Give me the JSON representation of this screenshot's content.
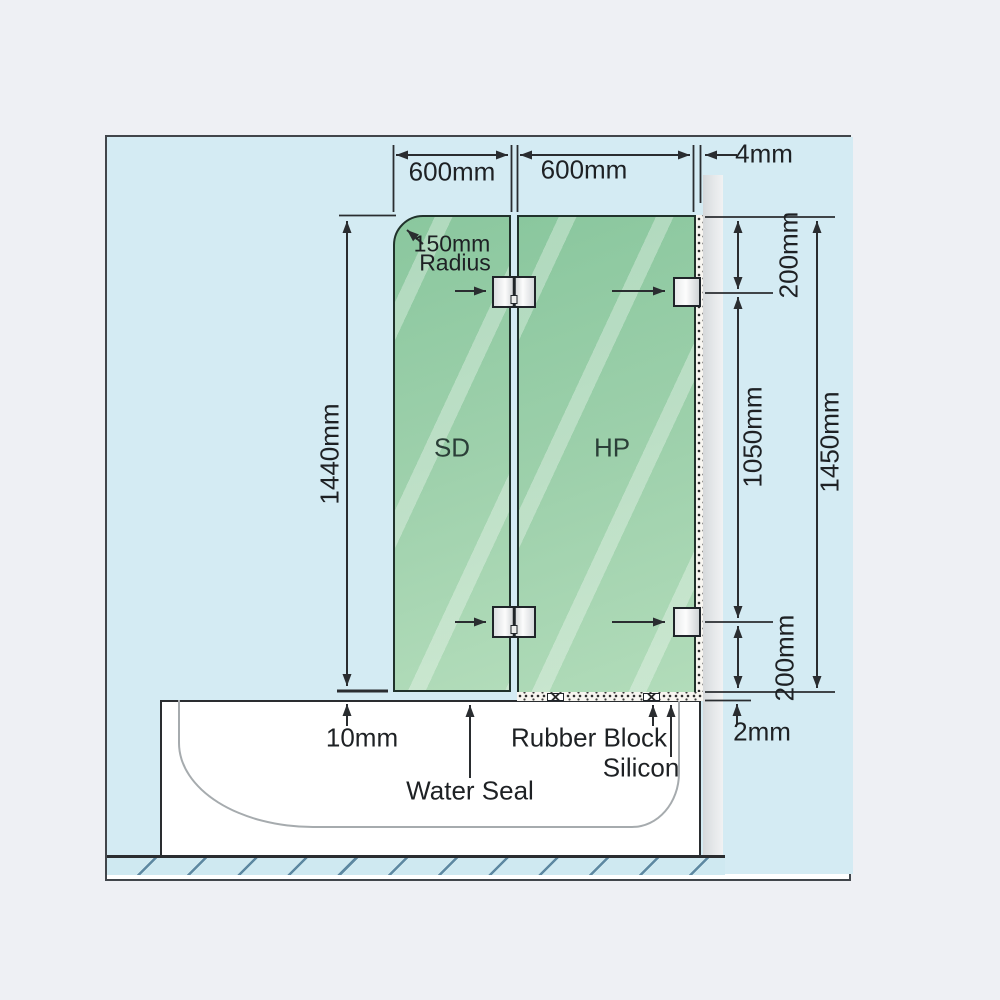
{
  "dimensions": {
    "panel_width_left": "600mm",
    "panel_width_right": "600mm",
    "wall_gap": "4mm",
    "door_height": "1440mm",
    "corner_radius_value": "150mm",
    "corner_radius_word": "Radius",
    "bracket_top_offset": "200mm",
    "bracket_spacing": "1050mm",
    "fixed_panel_height": "1450mm",
    "bracket_bottom_offset": "200mm",
    "door_bottom_gap": "10mm",
    "fixed_bottom_gap": "2mm"
  },
  "panels": {
    "door": "SD",
    "fixed": "HP"
  },
  "callouts": {
    "water_seal": "Water Seal",
    "rubber_block": "Rubber Block",
    "silicon": "Silicon"
  },
  "colors": {
    "page_background": "#eef0f4",
    "canvas_blue": "#d4ebf3",
    "glass_green": "#9dd0ab",
    "wall_gray": "#dcdfe1",
    "line": "#2a2d30"
  }
}
